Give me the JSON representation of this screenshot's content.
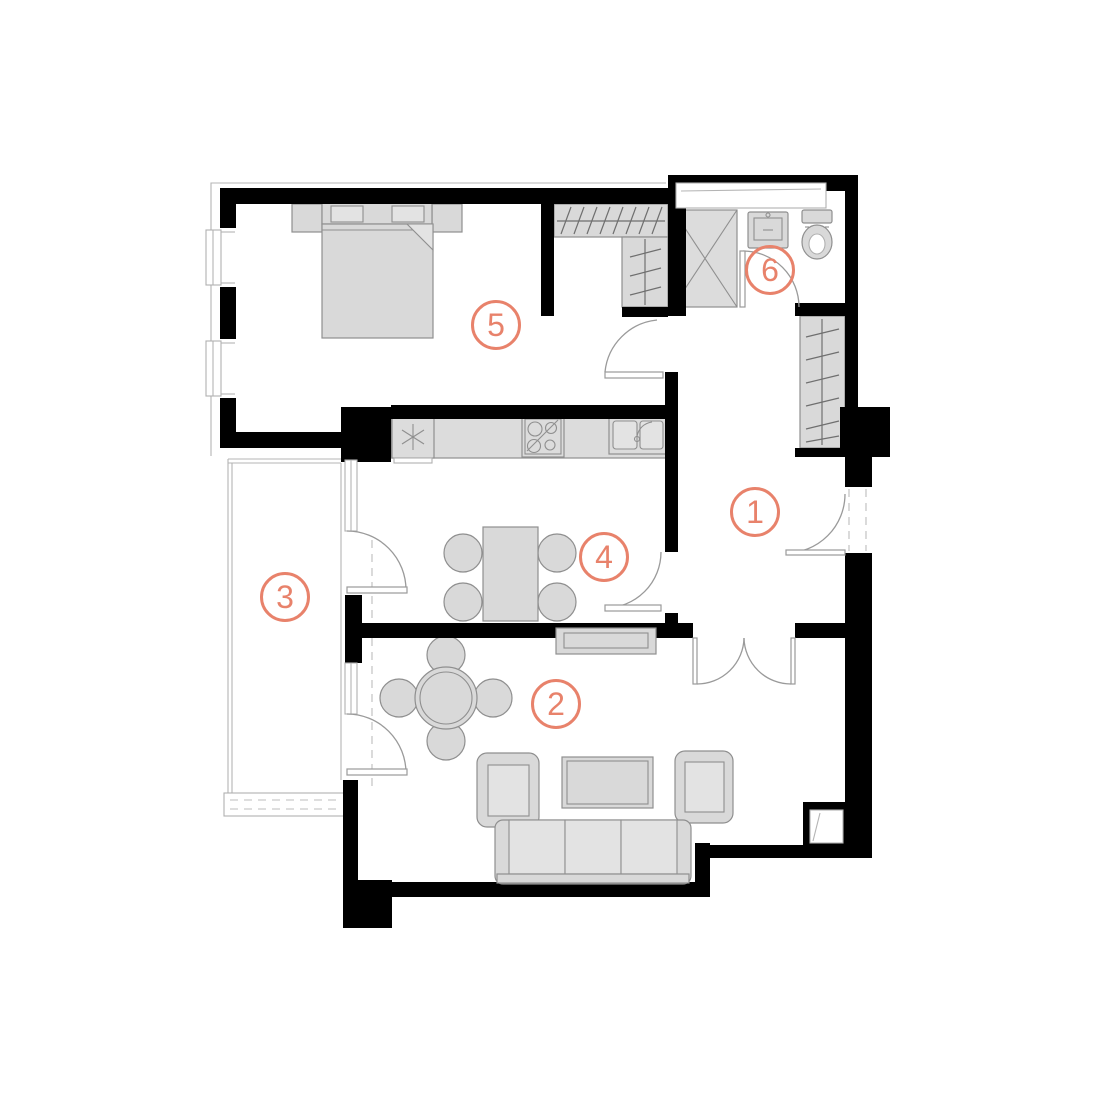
{
  "title": "Apartment floor plan",
  "colors": {
    "accent": "#E8826B",
    "wall": "#000000",
    "furniture_fill": "#D9D9D9",
    "furniture_stroke": "#8F8F8F"
  },
  "rooms": [
    {
      "label": "1",
      "name": "hallway"
    },
    {
      "label": "2",
      "name": "living-room"
    },
    {
      "label": "3",
      "name": "balcony"
    },
    {
      "label": "4",
      "name": "kitchen"
    },
    {
      "label": "5",
      "name": "bedroom"
    },
    {
      "label": "6",
      "name": "bathroom"
    }
  ],
  "fixtures": [
    "bed-icon",
    "wardrobe-hanger-icon",
    "shower-icon",
    "washbasin-icon",
    "toilet-icon",
    "fridge-icon",
    "stove-icon",
    "kitchen-sink-icon",
    "dining-table-icon",
    "round-table-icon",
    "sofa-icon",
    "armchair-icon",
    "coffee-table-icon",
    "tv-stand-icon",
    "door-swing-icon",
    "window-icon"
  ]
}
